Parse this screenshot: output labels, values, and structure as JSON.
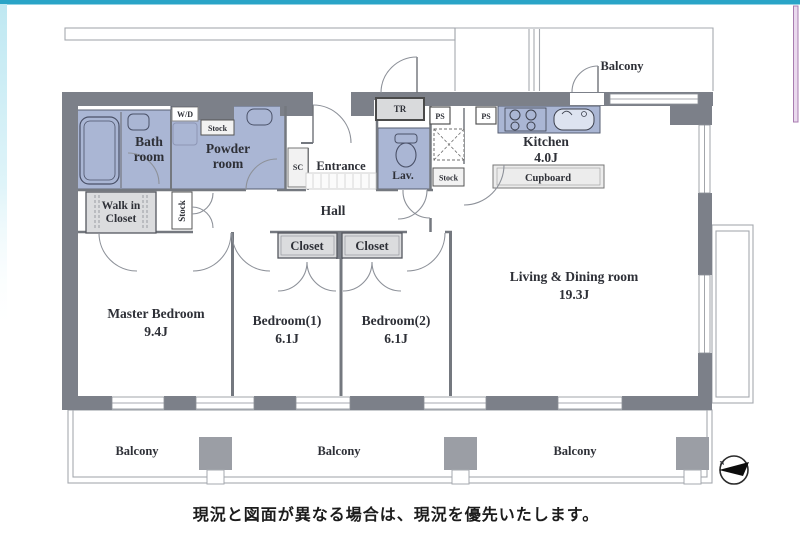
{
  "plan": {
    "rooms": {
      "bath": {
        "line1": "Bath",
        "line2": "room"
      },
      "powder": {
        "line1": "Powder",
        "line2": "room"
      },
      "walkin_closet": {
        "line1": "Walk in",
        "line2": "Closet"
      },
      "master_bedroom": {
        "name": "Master Bedroom",
        "size": "9.4J"
      },
      "bedroom1": {
        "name": "Bedroom(1)",
        "size": "6.1J"
      },
      "bedroom2": {
        "name": "Bedroom(2)",
        "size": "6.1J"
      },
      "living_dining": {
        "name": "Living & Dining room",
        "size": "19.3J"
      },
      "kitchen": {
        "name": "Kitchen",
        "size": "4.0J"
      },
      "entrance": {
        "name": "Entrance"
      },
      "hall": {
        "name": "Hall"
      },
      "lavatory": {
        "name": "Lav."
      },
      "closet1": {
        "name": "Closet"
      },
      "closet2": {
        "name": "Closet"
      },
      "cupboard": {
        "name": "Cupboard"
      }
    },
    "labels": {
      "wd": "W/D",
      "sc": "SC",
      "tr": "TR",
      "ps_left": "PS",
      "ps_right": "PS",
      "stock_powder": "Stock",
      "stock_hall": "Stock",
      "stock_kitchen": "Stock"
    },
    "balconies": {
      "top": "Balcony",
      "bottom_left": "Balcony",
      "bottom_center": "Balcony",
      "bottom_right": "Balcony"
    },
    "compass": {
      "label": "N"
    },
    "colors": {
      "wall": "#7c8089",
      "wet_area": "#aab6d4",
      "closet_fill": "#dbdcde",
      "top_accent": "#2aa4c7",
      "right_accent": "#a87cb0"
    }
  },
  "footer": {
    "caption": "現況と図面が異なる場合は、現況を優先いたします。"
  }
}
